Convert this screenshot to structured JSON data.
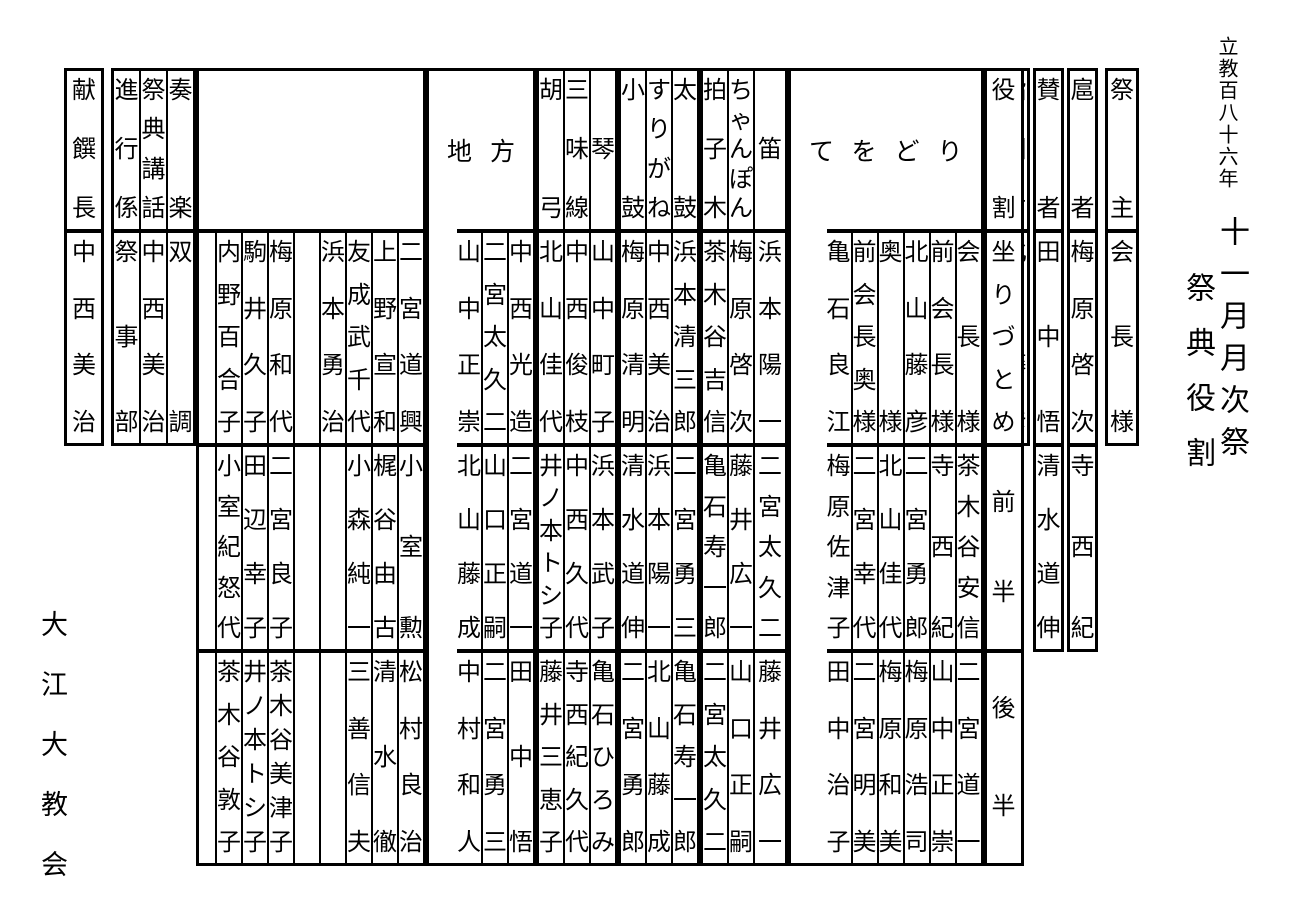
{
  "title": {
    "era_line": "立教百八十六年",
    "event_line": "十一月月次祭",
    "doc_line": "祭典役割"
  },
  "org": "大江大教会",
  "right_panel": {
    "saishu": {
      "label": "祭主",
      "value": "会長様"
    },
    "kosha": {
      "label": "扈者",
      "rows": [
        "梅原啓次",
        "寺西紀"
      ]
    },
    "sansha": {
      "label": "賛者",
      "rows": [
        "田中悟",
        "清水道伸"
      ]
    },
    "sashizu": {
      "label": "指図方",
      "rows": [
        "北山藤彦"
      ]
    }
  },
  "role_column": {
    "label": "役割",
    "rows": [
      "坐りづとめ",
      "前半",
      "後半"
    ]
  },
  "teodori": {
    "label": "てをどり",
    "columns": [
      {
        "rows": [
          "会長様",
          "茶木谷安信",
          "二宮道一"
        ]
      },
      {
        "rows": [
          "前会長様",
          "寺西紀",
          "山中正崇"
        ]
      },
      {
        "rows": [
          "北山藤彦",
          "二宮勇郎",
          "梅原浩司"
        ]
      },
      {
        "rows": [
          "奥様",
          "北山佳代",
          "梅原和美"
        ]
      },
      {
        "rows": [
          "前会長奥様",
          "二宮幸代",
          "二宮明美"
        ]
      },
      {
        "rows": [
          "亀石良江",
          "梅原佐津子",
          "田中治子"
        ]
      }
    ]
  },
  "fue_group": {
    "columns": [
      {
        "label": "笛",
        "rows": [
          "浜本陽一",
          "二宮太久二",
          "藤井広一"
        ]
      },
      {
        "label": "ちゃんぽん",
        "rows": [
          "梅原啓次",
          "藤井広一",
          "山口正嗣"
        ]
      },
      {
        "label": "拍子木",
        "rows": [
          "茶木谷吉信",
          "亀石寿一郎",
          "二宮太久二"
        ]
      }
    ]
  },
  "taiko_group": {
    "columns": [
      {
        "label": "太鼓",
        "rows": [
          "浜本清三郎",
          "二宮勇三",
          "亀石寿一郎"
        ]
      },
      {
        "label": "すりがね",
        "rows": [
          "中西美治",
          "浜本陽一",
          "北山藤成"
        ]
      },
      {
        "label": "小鼓",
        "rows": [
          "梅原清明",
          "清水道伸",
          "二宮勇郎"
        ]
      }
    ]
  },
  "koto_group": {
    "columns": [
      {
        "label": "琴",
        "rows": [
          "山中町子",
          "浜本武子",
          "亀石ひろみ"
        ]
      },
      {
        "label": "三味線",
        "rows": [
          "中西俊枝",
          "中西久代",
          "寺西紀久代"
        ]
      },
      {
        "label": "胡弓",
        "rows": [
          "北山佳代",
          "井ノ本トシ子",
          "藤井三恵子"
        ]
      }
    ]
  },
  "jikata": {
    "label": "地方",
    "columns": [
      {
        "rows": [
          "中西光造",
          "二宮道一",
          "田中悟"
        ]
      },
      {
        "rows": [
          "二宮太久二",
          "山口正嗣",
          "二宮勇三"
        ]
      },
      {
        "rows": [
          "山中正崇",
          "北山藤成",
          "中村和人"
        ]
      }
    ]
  },
  "ensemble": {
    "label": "",
    "columns": [
      {
        "rows": [
          "二宮道興",
          "小室勲",
          "松村良治"
        ]
      },
      {
        "rows": [
          "上野宣和",
          "梶谷由古",
          "清水徹"
        ]
      },
      {
        "rows": [
          "友成武千代",
          "小森純一",
          "三善信夫"
        ]
      },
      {
        "rows": [
          "浜本勇治",
          "",
          ""
        ]
      },
      {
        "rows": [
          "",
          "",
          ""
        ]
      },
      {
        "rows": [
          "梅原和代",
          "二宮良子",
          "茶木谷美津子"
        ]
      },
      {
        "rows": [
          "駒井久子",
          "田辺幸子",
          "井ノ本トシ子"
        ]
      },
      {
        "rows": [
          "内野百合子",
          "小室紀怒代",
          "茶木谷敦子"
        ]
      },
      {
        "rows": [
          "",
          "",
          ""
        ]
      }
    ]
  },
  "left_panel": {
    "sogaku": {
      "label": "奏楽",
      "value": "双調"
    },
    "kowa": {
      "label": "祭典講話",
      "value": "中西美治"
    },
    "shinko": {
      "label": "進行係",
      "value": "祭事部"
    },
    "kensen": {
      "label": "献饌長",
      "value": "中西美治"
    }
  },
  "colors": {
    "ink": "#000000",
    "paper": "#ffffff"
  }
}
